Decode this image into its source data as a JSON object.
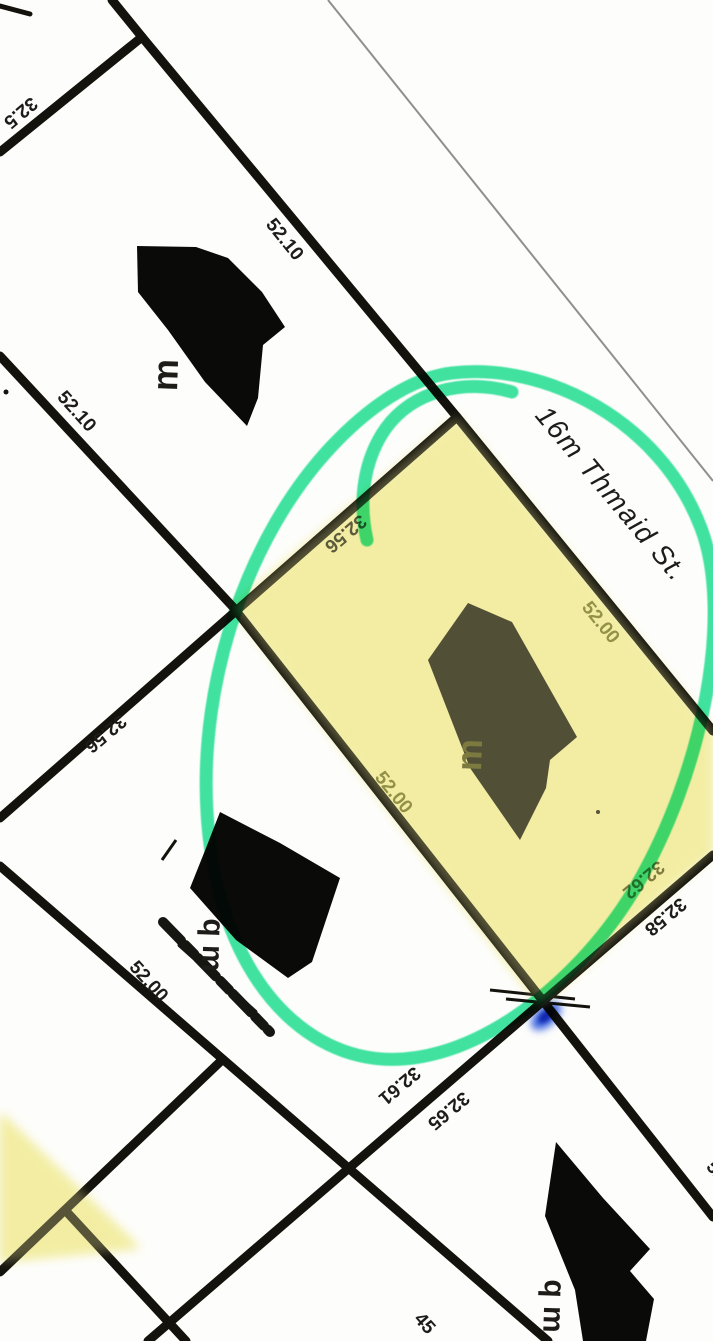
{
  "document": {
    "type": "scanned cadastral plat map",
    "street": {
      "label": "16m Thmaid St.",
      "x": 610,
      "y": 495,
      "rot": 50,
      "size": 28
    }
  },
  "colors": {
    "bg": "#fdfdfb",
    "line": "#13120c",
    "thin_line": "#8f8f8f",
    "label": "#1d1c18",
    "label_olive": "#6e6e2f",
    "label_dark_olive": "#4c4c1e",
    "highlight": "#f4efa5",
    "marker": "#30e29b",
    "blue_mark": "#1e4fe0"
  },
  "parcel_lines": [
    {
      "x1": 112,
      "y1": 0,
      "x2": 142,
      "y2": 37
    },
    {
      "x1": 142,
      "y1": 37,
      "x2": 0,
      "y2": 152
    },
    {
      "x1": 142,
      "y1": 37,
      "x2": 457,
      "y2": 417
    },
    {
      "x1": 0,
      "y1": 356,
      "x2": 233,
      "y2": 607
    },
    {
      "x1": 457,
      "y1": 417,
      "x2": 0,
      "y2": 818
    },
    {
      "x1": 457,
      "y1": 417,
      "x2": 713,
      "y2": 731
    },
    {
      "x1": 233,
      "y1": 607,
      "x2": 713,
      "y2": 1217
    },
    {
      "x1": 713,
      "y1": 855,
      "x2": 148,
      "y2": 1341
    },
    {
      "x1": 0,
      "y1": 866,
      "x2": 548,
      "y2": 1341
    },
    {
      "x1": 222,
      "y1": 1060,
      "x2": 0,
      "y2": 1272
    },
    {
      "x1": 65,
      "y1": 1210,
      "x2": 186,
      "y2": 1341
    },
    {
      "x1": 0,
      "y1": 6,
      "x2": 30,
      "y2": 14,
      "w": 5
    }
  ],
  "thin_lines": [
    {
      "x1": 328,
      "y1": 0,
      "x2": 713,
      "y2": 481,
      "w": 2
    }
  ],
  "dimension_labels": [
    {
      "text": "32.5",
      "x": 20,
      "y": 112,
      "rot": 140,
      "color": "label"
    },
    {
      "text": "52.10",
      "x": 284,
      "y": 240,
      "rot": 51,
      "color": "label"
    },
    {
      "text": "52.10",
      "x": 76,
      "y": 412,
      "rot": 48,
      "color": "label"
    },
    {
      "text": "32.56",
      "x": 345,
      "y": 533,
      "rot": 140,
      "color": "label"
    },
    {
      "text": "32.56",
      "x": 105,
      "y": 733,
      "rot": 140,
      "color": "label"
    },
    {
      "text": "52.00",
      "x": 600,
      "y": 623,
      "rot": 51,
      "color": "label_olive"
    },
    {
      "text": "52.00",
      "x": 393,
      "y": 793,
      "rot": 51,
      "color": "label_olive"
    },
    {
      "text": "32.62",
      "x": 643,
      "y": 879,
      "rot": 140,
      "color": "label_dark_olive"
    },
    {
      "text": "32.58",
      "x": 665,
      "y": 916,
      "rot": 140,
      "color": "label"
    },
    {
      "text": "32.61",
      "x": 399,
      "y": 1085,
      "rot": 140,
      "color": "label"
    },
    {
      "text": "32.65",
      "x": 448,
      "y": 1110,
      "rot": 140,
      "color": "label"
    },
    {
      "text": "52.00",
      "x": 148,
      "y": 982,
      "rot": 48,
      "color": "label"
    },
    {
      "text": "52",
      "x": 716,
      "y": 1172,
      "rot": 50,
      "color": "label"
    },
    {
      "text": "45",
      "x": 424,
      "y": 1324,
      "rot": 48,
      "color": "label"
    }
  ],
  "unit_marks": [
    {
      "text": "m",
      "x": 168,
      "y": 375,
      "rot": -88,
      "size": 36,
      "color": "label"
    },
    {
      "text": "m",
      "x": 472,
      "y": 755,
      "rot": -88,
      "size": 36,
      "color": "label_dark_olive"
    },
    {
      "text": "q m",
      "x": 211,
      "y": 945,
      "rot": 92,
      "size": 30,
      "color": "label"
    },
    {
      "text": "q m",
      "x": 552,
      "y": 1306,
      "rot": 92,
      "size": 30,
      "color": "label"
    }
  ],
  "redaction_blobs": [
    {
      "points": "137,246 196,247 228,258 262,292 285,327 263,345 258,398 247,426 205,382 168,330 138,292"
    },
    {
      "points": "468,603 512,622 577,737 550,760 546,788 520,840 470,768 428,660"
    },
    {
      "points": "220,812 280,843 340,878 312,962 288,978 236,940 190,888 206,848"
    },
    {
      "points": "556,1142 603,1198 650,1249 630,1271 654,1299 646,1341 583,1341 575,1290 545,1216"
    }
  ],
  "scribbles": [
    {
      "x1": 163,
      "y1": 922,
      "x2": 270,
      "y2": 1032,
      "w": 10,
      "dash": "26 6 13 5"
    },
    {
      "x1": 180,
      "y1": 945,
      "x2": 255,
      "y2": 1012,
      "w": 5,
      "dash": "30 8"
    }
  ],
  "survey_ticks": [
    {
      "x1": 490,
      "y1": 990,
      "x2": 575,
      "y2": 999,
      "w": 3
    },
    {
      "x1": 506,
      "y1": 999,
      "x2": 590,
      "y2": 1007,
      "w": 3
    },
    {
      "x1": 162,
      "y1": 860,
      "x2": 176,
      "y2": 840,
      "w": 3
    }
  ],
  "specks": [
    {
      "x": 598,
      "y": 812,
      "r": 2
    },
    {
      "x": 6,
      "y": 392,
      "r": 2.5
    }
  ],
  "highlighter_regions": [
    {
      "points": "457,417 713,731 713,852 540,1005 233,607"
    },
    {
      "points": "0,1112 140,1248 0,1262"
    }
  ],
  "marker_annotation": {
    "loop_path": "M452,373 C545,362 660,420 701,528 C733,612 705,770 634,890 C575,988 463,1075 366,1057 C282,1041 215,952 207,812 C199,680 248,535 332,446 C368,408 410,378 452,373",
    "tail_path": "M512,392 C462,378 412,392 386,428 C364,459 358,500 367,540",
    "stroke_width": 13
  },
  "pen_mark": {
    "cx": 546,
    "cy": 1016,
    "rx": 10,
    "ry": 18,
    "rot": 48
  }
}
